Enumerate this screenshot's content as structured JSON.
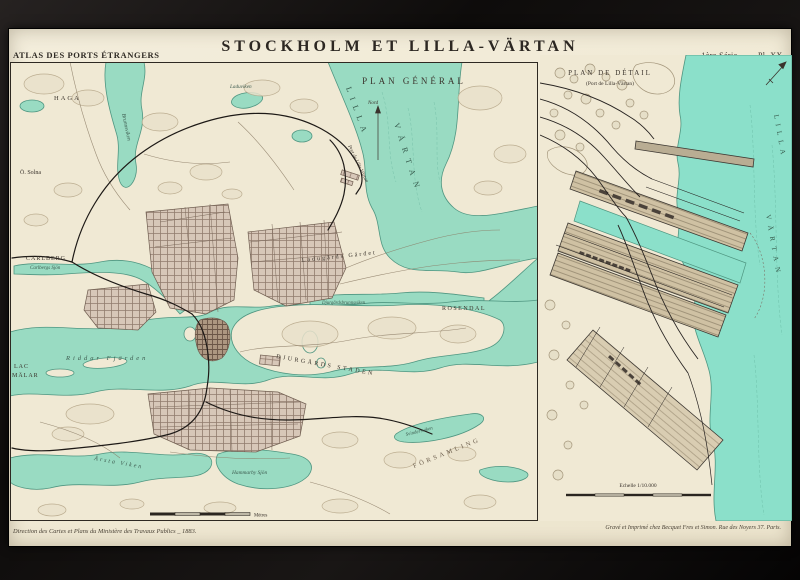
{
  "header": {
    "atlas": "ATLAS DES PORTS ÉTRANGERS",
    "title": "STOCKHOLM ET LILLA-VÄRTAN",
    "plate": "1ère Série. ___ Pl. XX."
  },
  "main_map": {
    "subtitle": "PLAN GÉNÉRAL",
    "labels": {
      "haga": "HAGA",
      "solna": "Ö. Solna",
      "brunnsviken": "Brunnsviken",
      "laduviken": "Laduviken",
      "carlberg": "CARLBERG",
      "carlberg_sjon": "Carlbergs Sjön",
      "lilla": "LILLA",
      "vartan": "VÄRTAN",
      "nord": "Nord",
      "port": "Port de Lilla Värtan",
      "gardet": "Ladugårds Gärdet",
      "djbviken": "Djurgårdsbrunnsviken",
      "rosendal": "ROSENDAL",
      "djurgardsstaden": "DJURGÅRDS STADEN",
      "riddarfjarden": "Riddar Fjärden",
      "lac": "LAC",
      "malar": "MÄLAR",
      "arstaviken": "Årsta Viken",
      "hammarby": "Hammarby Sjön",
      "svindersviken": "Svindersviken",
      "forsamling": "FÖRSAMLING",
      "metres": "Mètres"
    }
  },
  "detail_map": {
    "title": "PLAN DE DÉTAIL",
    "subtitle": "(Port de Lilla-Värtan)",
    "labels": {
      "lilla": "LILLA",
      "vartan": "VÄRTAN"
    },
    "scale": "Echelle 1/10.000"
  },
  "footer": {
    "credit_left": "Direction des Cartes et Plans du Ministère des Travaux Publics _ 1883.",
    "credit_right": "Gravé et Imprimé chez Becquet Fres et Simon. Rue des Noyers 37. Paris."
  },
  "colors": {
    "paper": "#f1ebd8",
    "water": "#99dbc2",
    "water_detail": "#8be0ca",
    "frame": "#141110",
    "ink": "#3a332c"
  }
}
